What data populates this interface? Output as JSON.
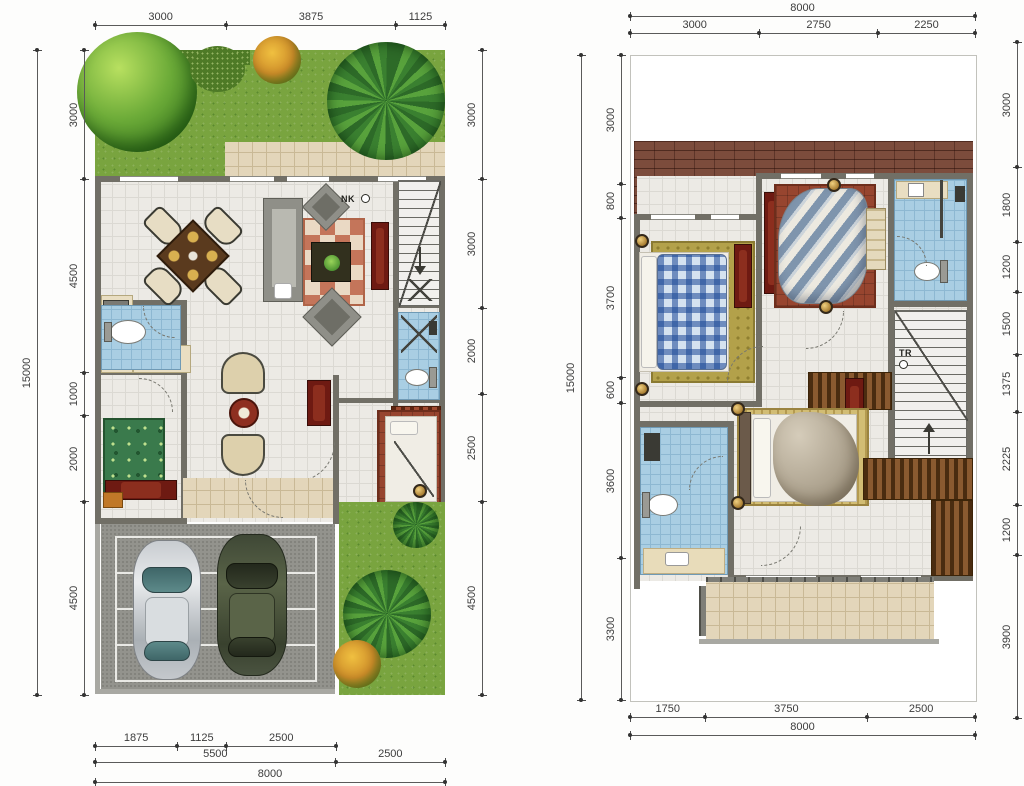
{
  "figure": {
    "type": "architectural-floor-plan",
    "panels": [
      "ground-floor-left",
      "upper-floor-right"
    ],
    "units": "mm"
  },
  "left_plan": {
    "stair_label": "NK",
    "dims": {
      "top": [
        "3000",
        "3875",
        "1125"
      ],
      "left_total": [
        "15000"
      ],
      "left": [
        "3000",
        "4500",
        "1000",
        "2000",
        "4500"
      ],
      "right": [
        "3000",
        "3000",
        "2000",
        "2500",
        "4500"
      ],
      "bottom_row1": [
        "1875",
        "1125",
        "2500"
      ],
      "bottom_row2": [
        "5500",
        "2500"
      ],
      "bottom_total": [
        "8000"
      ]
    }
  },
  "right_plan": {
    "stair_label": "TR",
    "dims": {
      "top_total": [
        "8000"
      ],
      "top": [
        "3000",
        "2750",
        "2250"
      ],
      "left_total": [
        "15000"
      ],
      "left": [
        "3000",
        "800",
        "3700",
        "600",
        "3600",
        "3300"
      ],
      "right": [
        "3000",
        "1800",
        "1200",
        "1500",
        "1375",
        "2225",
        "1200",
        "3900"
      ],
      "bottom": [
        "1750",
        "3750",
        "2500"
      ],
      "bottom_total": [
        "8000"
      ]
    }
  },
  "palette": {
    "wall": "#716f66",
    "floor_tile": "#eceae5",
    "bath_tile": "#a9cee3",
    "terrace_tile": "#e3d6ba",
    "grass": "#79a43f",
    "roof": "#7c4c3c",
    "wood_dark": "#6e1a12",
    "rug_terracotta": "#c4755a",
    "rug_green": "#3a7a4c",
    "asphalt": "#93938d",
    "car_silver": "#c8ccd0",
    "car_green": "#4e5840"
  }
}
